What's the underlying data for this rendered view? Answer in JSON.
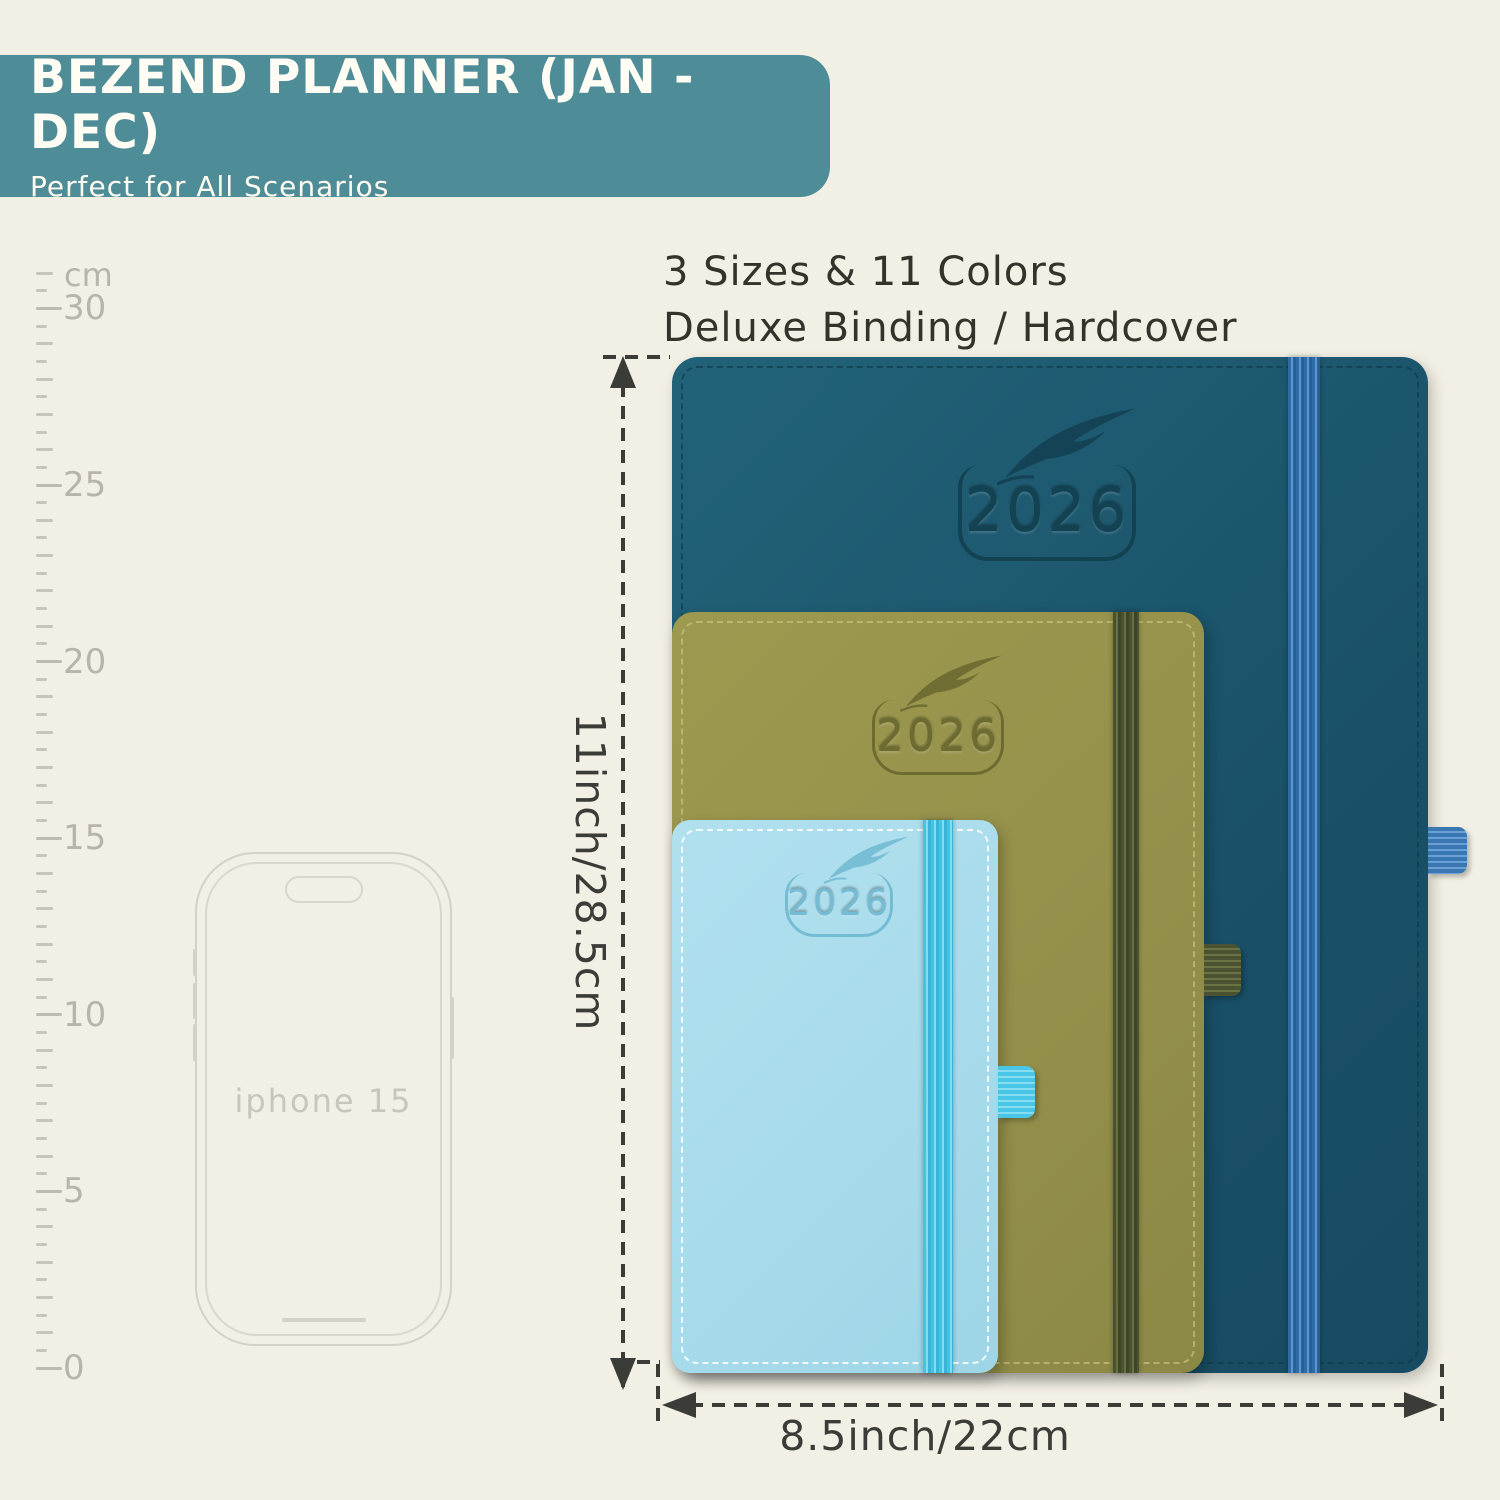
{
  "header": {
    "title": "BEZEND PLANNER (JAN - DEC)",
    "subtitle": "Perfect for All Scenarios"
  },
  "info": {
    "line1": "3 Sizes & 11 Colors",
    "line2": "Deluxe Binding / Hardcover"
  },
  "ruler": {
    "unit": "cm",
    "labels": [
      30,
      25,
      20,
      15,
      10,
      5,
      0
    ],
    "max_cm": 31
  },
  "phone": {
    "label": "iphone 15"
  },
  "planners": [
    {
      "name": "large",
      "year": "2026",
      "cover_color": "#1d5a70",
      "band_color": "#2e6ca8"
    },
    {
      "name": "medium",
      "year": "2026",
      "cover_color": "#97934e",
      "band_color": "#4b5231"
    },
    {
      "name": "small",
      "year": "2026",
      "cover_color": "#a9dcec",
      "band_color": "#45c3e3"
    }
  ],
  "dimensions": {
    "height_label": "11inch/28.5cm",
    "width_label": "8.5inch/22cm"
  },
  "colors": {
    "background": "#f2efe4",
    "header_bg": "#4e8c98",
    "annotation": "#3b3b37",
    "ruler_gray": "#c7c4b9"
  }
}
